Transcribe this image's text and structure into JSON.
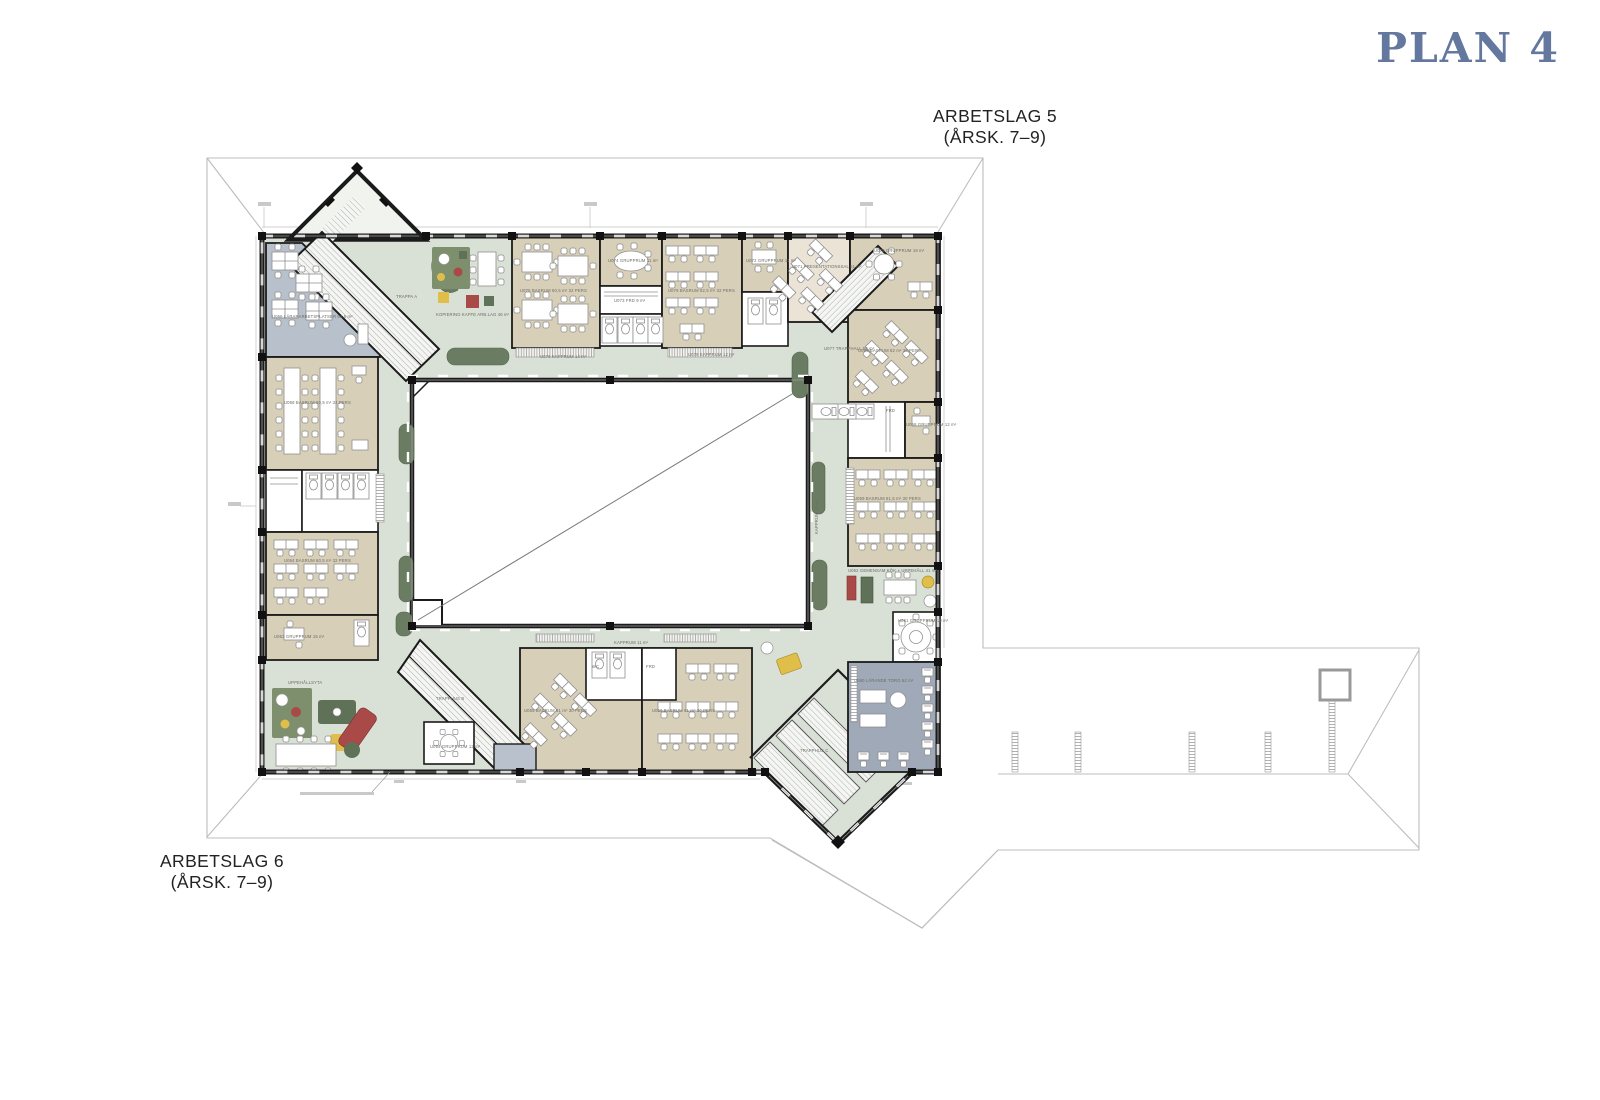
{
  "title": "PLAN 4",
  "workgroup_top": {
    "name": "ARBETSLAG 5",
    "grades": "(ÅRSK. 7–9)"
  },
  "workgroup_bottom": {
    "name": "ARBETSLAG 6",
    "grades": "(ÅRSK. 7–9)"
  },
  "colors": {
    "accent": "#64779e",
    "corridor": "#d9e0d5",
    "room": "#d8cfb9",
    "roomLight": "#eae3d6",
    "teacher": "#b7c0cb",
    "media": "#9fa9b8",
    "grayroom": "#b9c1cc",
    "planter": "#6a7c62",
    "red": "#a94a48",
    "yellow": "#e0be4a",
    "green": "#5f7257",
    "rug": "#7e8f6e"
  },
  "room_labels": [
    {
      "x": 272,
      "y": 318,
      "t": "U066 LÄRARARBETSPLATSER 51,5 m²"
    },
    {
      "x": 284,
      "y": 404,
      "t": "U068 BASRUM 60,5 m² 32 PERS"
    },
    {
      "x": 284,
      "y": 562,
      "t": "U064 BASRUM 60,5 m² 32 PERS"
    },
    {
      "x": 274,
      "y": 638,
      "t": "U063 GRUPPRUM 15 m²"
    },
    {
      "x": 520,
      "y": 292,
      "t": "U075 BASRUM 60,5 m² 32 PERS"
    },
    {
      "x": 668,
      "y": 292,
      "t": "U076 BASRUM 62,5 m² 32 PERS"
    },
    {
      "x": 608,
      "y": 262,
      "t": "U074 GRUPPRUM 11 m²"
    },
    {
      "x": 614,
      "y": 302,
      "t": "U073 FRD 9 m²"
    },
    {
      "x": 746,
      "y": 262,
      "t": "U072 GRUPPRUM 11 m²"
    },
    {
      "x": 792,
      "y": 268,
      "t": "U071 PRESENTATIONSSAL 51 m²"
    },
    {
      "x": 874,
      "y": 252,
      "t": "U070 GRUPPRUM 18 m²"
    },
    {
      "x": 858,
      "y": 352,
      "t": "U069 BASRUM 62 m² 32 PERS"
    },
    {
      "x": 906,
      "y": 426,
      "t": "U058 GRUPPRUM 12 m²"
    },
    {
      "x": 886,
      "y": 412,
      "t": "FRD"
    },
    {
      "x": 854,
      "y": 500,
      "t": "U059 BASRUM 61,5 m² 30 PERS"
    },
    {
      "x": 848,
      "y": 572,
      "t": "U062 GEMENSAM KÖK + UPPEHÅLL 41 m²"
    },
    {
      "x": 898,
      "y": 622,
      "t": "U061 GRUPPRUM 19 m²"
    },
    {
      "x": 854,
      "y": 682,
      "t": "U060 LÄRANDE TORG 62 m²"
    },
    {
      "x": 524,
      "y": 712,
      "t": "U055 BASRUM 61 m² 30 PERS"
    },
    {
      "x": 652,
      "y": 712,
      "t": "U056 BASRUM 61 m² 30 PERS"
    },
    {
      "x": 592,
      "y": 668,
      "t": "WC"
    },
    {
      "x": 646,
      "y": 668,
      "t": "FRD"
    },
    {
      "x": 540,
      "y": 358,
      "t": "U078 KAPPRUM 14 m²"
    },
    {
      "x": 688,
      "y": 356,
      "t": "U079 KAPPRUM 12 m²"
    },
    {
      "x": 818,
      "y": 534,
      "t": "KAPPRUM 12 m²",
      "r": -90
    },
    {
      "x": 614,
      "y": 644,
      "t": "KAPPRUM 11 m²"
    },
    {
      "x": 436,
      "y": 316,
      "t": "KOPIERING KAFFE ARB.LAG 46 m²"
    },
    {
      "x": 396,
      "y": 298,
      "t": "TRAPPA A"
    },
    {
      "x": 824,
      "y": 350,
      "t": "U077 TRAPPHALL 58 m²"
    },
    {
      "x": 436,
      "y": 700,
      "t": "TRAPPHUS B"
    },
    {
      "x": 800,
      "y": 752,
      "t": "TRAPPHUS C"
    },
    {
      "x": 288,
      "y": 684,
      "t": "UPPEHÅLLSYTA"
    },
    {
      "x": 430,
      "y": 748,
      "t": "U054 GRUPPRUM 12 m²"
    }
  ]
}
